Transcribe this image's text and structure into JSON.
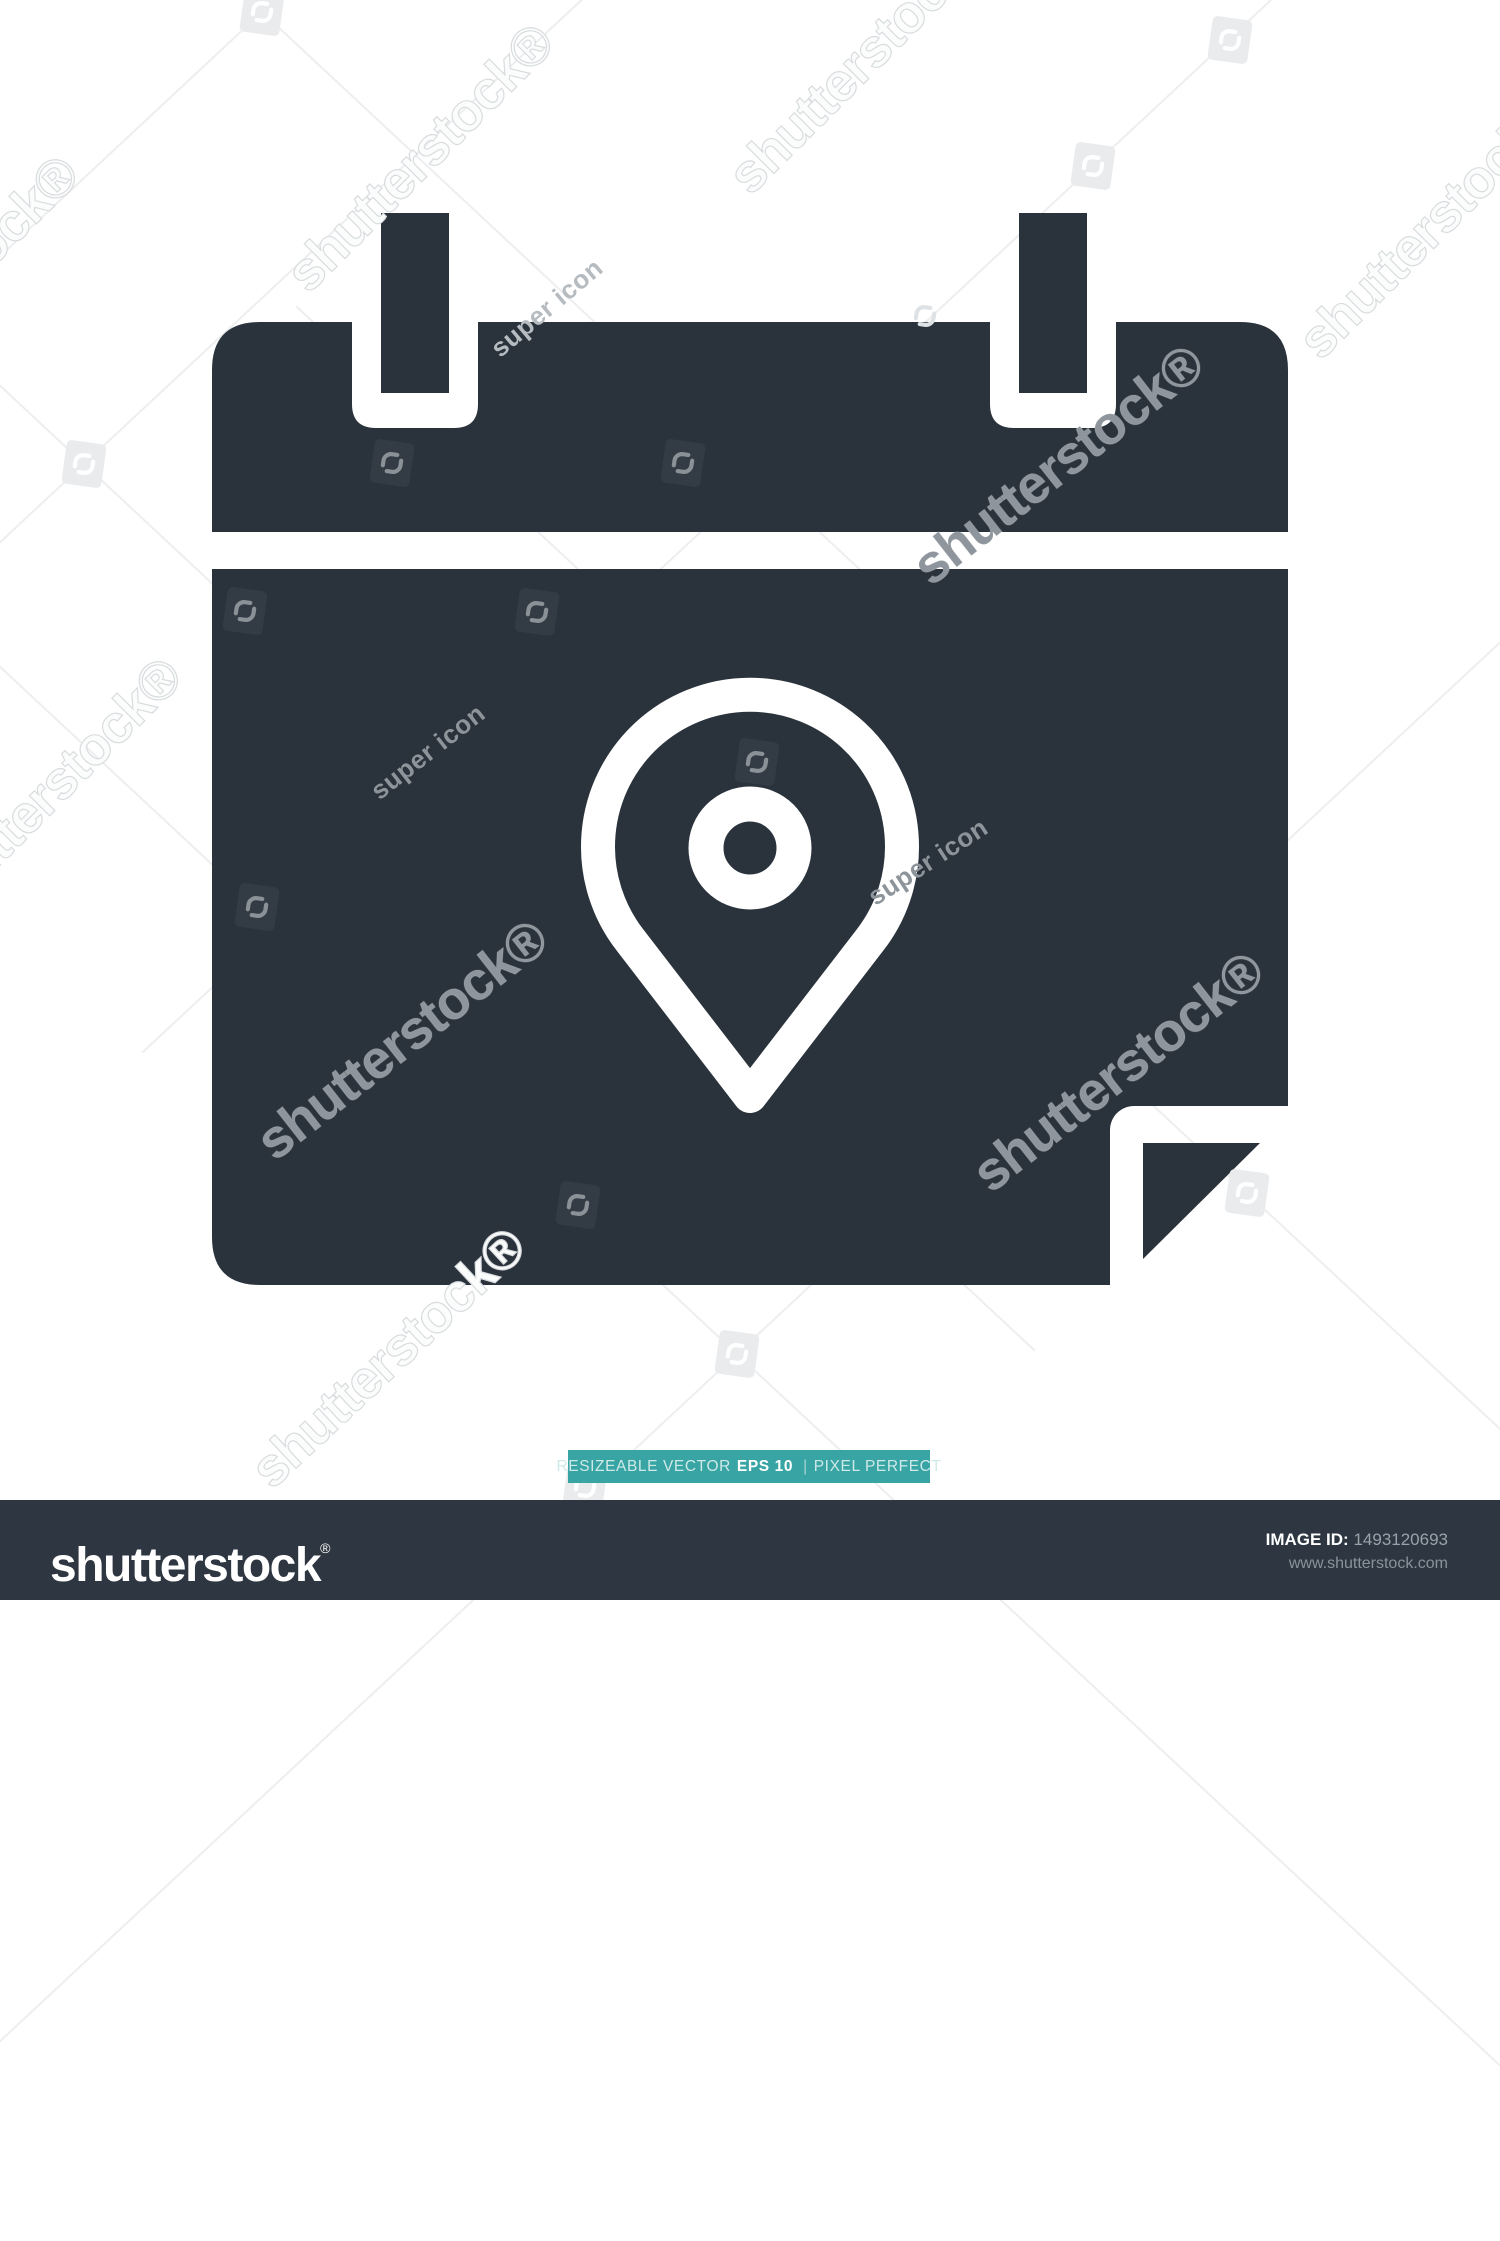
{
  "colors": {
    "icon_dark": "#2A333C",
    "footer_bg": "#2D3641",
    "banner_teal": "#38A5A4",
    "watermark_line": "#EDEEF0"
  },
  "watermark": {
    "brand_text": "shutterstock®",
    "contributor_text": "super icon",
    "texts": [
      {
        "x": 420,
        "y": 158,
        "rot": -45,
        "kind": "brand",
        "style": "embossed"
      },
      {
        "x": 862,
        "y": 60,
        "rot": -45,
        "kind": "brand",
        "style": "embossed"
      },
      {
        "x": 1432,
        "y": 225,
        "rot": -45,
        "kind": "brand",
        "style": "embossed"
      },
      {
        "x": -55,
        "y": 290,
        "rot": -45,
        "kind": "brand",
        "style": "embossed"
      },
      {
        "x": 48,
        "y": 792,
        "rot": -45,
        "kind": "brand",
        "style": "embossed"
      },
      {
        "x": 388,
        "y": 1358,
        "rot": -43,
        "kind": "brand",
        "style": "embossed"
      },
      {
        "x": 402,
        "y": 1040,
        "rot": -38,
        "kind": "brand",
        "style": "graydark"
      },
      {
        "x": 1118,
        "y": 1072,
        "rot": -38,
        "kind": "brand",
        "style": "graydark"
      },
      {
        "x": 1058,
        "y": 465,
        "rot": -38,
        "kind": "brand",
        "style": "graydark"
      },
      {
        "x": 428,
        "y": 752,
        "rot": -38,
        "kind": "contrib",
        "style": "contrib-dark"
      },
      {
        "x": 928,
        "y": 862,
        "rot": -33,
        "kind": "contrib",
        "style": "contrib-dark"
      },
      {
        "x": 547,
        "y": 308,
        "rot": -40,
        "kind": "contrib",
        "style": "contrib-light"
      }
    ],
    "tiles": [
      {
        "x": 392,
        "y": 463,
        "variant": "dark"
      },
      {
        "x": 683,
        "y": 463,
        "variant": "dark"
      },
      {
        "x": 245,
        "y": 611,
        "variant": "dark"
      },
      {
        "x": 537,
        "y": 612,
        "variant": "dark"
      },
      {
        "x": 757,
        "y": 762,
        "variant": "dark"
      },
      {
        "x": 257,
        "y": 907,
        "variant": "dark"
      },
      {
        "x": 578,
        "y": 1205,
        "variant": "dark"
      },
      {
        "x": 262,
        "y": 12,
        "variant": "light"
      },
      {
        "x": 1230,
        "y": 40,
        "variant": "light"
      },
      {
        "x": 1093,
        "y": 166,
        "variant": "light"
      },
      {
        "x": 84,
        "y": 464,
        "variant": "light"
      },
      {
        "x": 737,
        "y": 1354,
        "variant": "light"
      },
      {
        "x": 1247,
        "y": 1193,
        "variant": "light"
      },
      {
        "x": 585,
        "y": 1487,
        "variant": "light"
      },
      {
        "x": 925,
        "y": 316,
        "variant": "ghost"
      }
    ],
    "lines": [
      {
        "x": 262,
        "y": 12,
        "rot": 43
      },
      {
        "x": 84,
        "y": 464,
        "rot": 43
      },
      {
        "x": 737,
        "y": 1354,
        "rot": 43
      },
      {
        "x": 1247,
        "y": 1193,
        "rot": 43
      },
      {
        "x": 1093,
        "y": 166,
        "rot": -43
      },
      {
        "x": 84,
        "y": 464,
        "rot": -43
      },
      {
        "x": 737,
        "y": 1354,
        "rot": -43
      },
      {
        "x": 262,
        "y": 12,
        "rot": -43
      }
    ]
  },
  "banner": {
    "prefix": "RESIZEABLE VECTOR",
    "bold": "EPS 10",
    "separator": "|",
    "suffix": "PIXEL PERFECT"
  },
  "footer": {
    "logo": "shutterstock",
    "registered": "®",
    "image_id_label": "IMAGE ID:",
    "image_id": "1493120693",
    "website": "www.shutterstock.com"
  }
}
